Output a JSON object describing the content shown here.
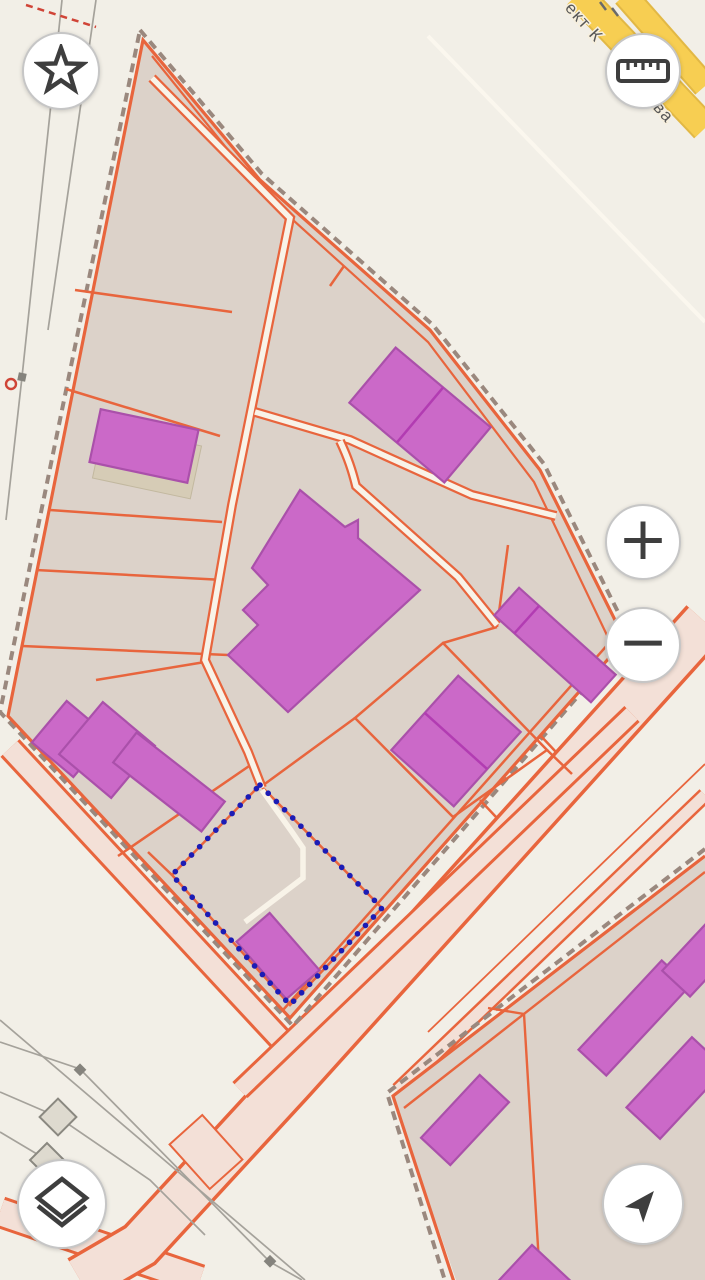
{
  "street_label": {
    "fragment_top": "ект К",
    "fragment_bottom": "ава"
  },
  "controls": {
    "favorites": {
      "icon": "star-icon"
    },
    "measure": {
      "icon": "ruler-icon"
    },
    "zoom_in": {
      "icon": "plus-icon",
      "glyph": "+"
    },
    "zoom_out": {
      "icon": "minus-icon",
      "glyph": "−"
    },
    "layers": {
      "icon": "layers-icon"
    },
    "locate": {
      "icon": "navigation-arrow-icon"
    }
  },
  "map": {
    "selection_style": "blue-dotted-outline"
  },
  "palette": {
    "background": "#f2efe7",
    "block_fill": "#dcd2c9",
    "parcel_line": "#e8653d",
    "block_dash": "#9a887e",
    "building_fill": "#cb69c8",
    "building_stroke": "#aa50aa",
    "building_divider": "#b23cb2",
    "selection_blue": "#1c1cb5",
    "path_cream": "#f8f3e8",
    "road_pink": "#f3e0d7",
    "road_yellow": "#f7ce52",
    "road_yellow_casing": "#e2b845",
    "gray_line": "#a5a29b",
    "label_gray": "#575757",
    "button_bg": "#ffffff",
    "button_border": "#c6c6c6",
    "icon_color": "#3e3e3e",
    "shadow_tan": "#d6ccb6"
  }
}
